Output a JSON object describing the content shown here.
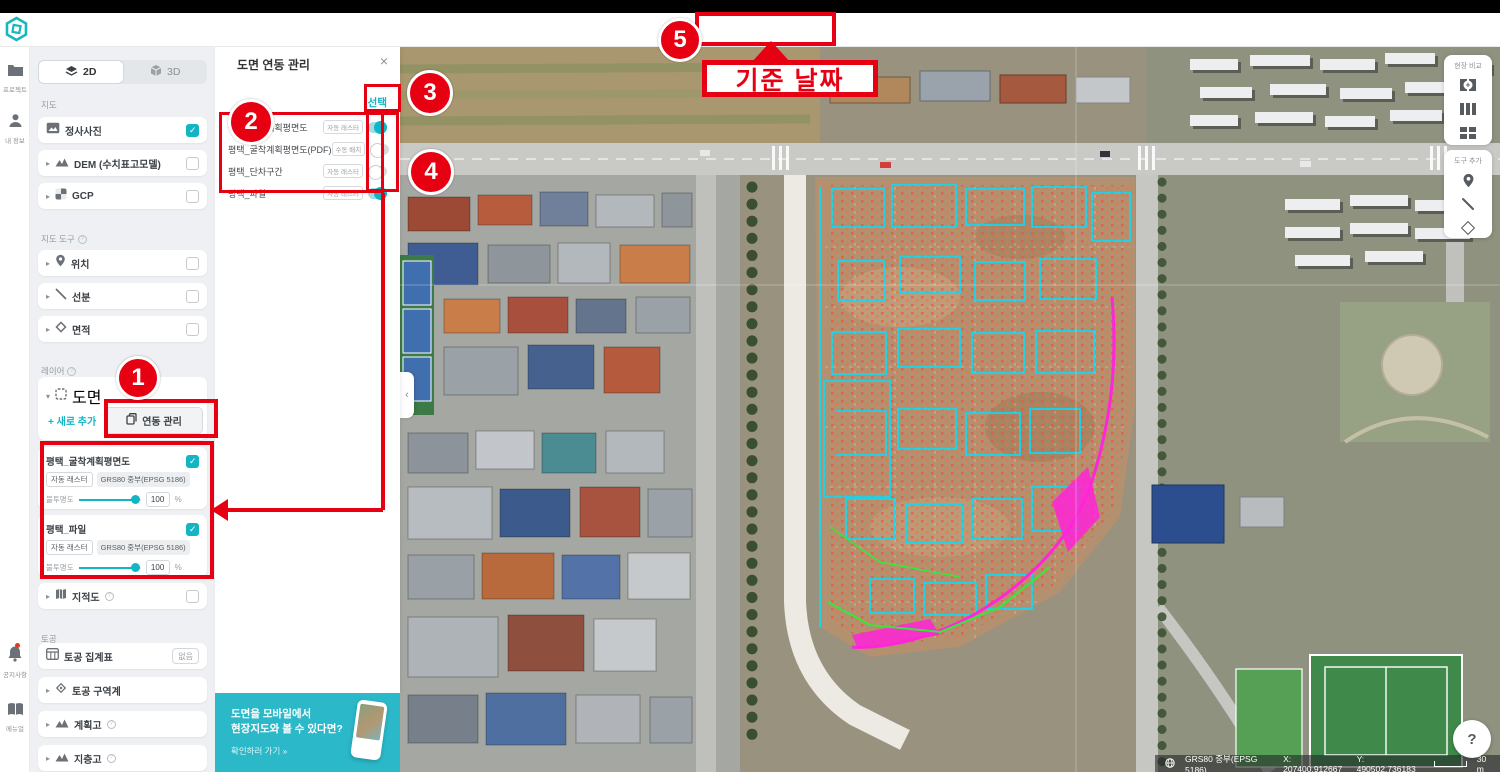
{
  "header": {
    "title": "[meissa] demo site",
    "date_label": "2020년 11월 24일 (화)",
    "admin_badge": "최고 관리자"
  },
  "icons": {
    "back": "←",
    "chevron_right": "›",
    "close": "×",
    "more": "⋯",
    "expand": "▸",
    "collapse": "▾",
    "panel_collapse": "‹",
    "check": "✓"
  },
  "rail": {
    "items": [
      {
        "label": "프로젝트"
      },
      {
        "label": "내 정보"
      },
      {
        "label": "공지사항"
      },
      {
        "label": "메뉴얼"
      }
    ]
  },
  "panel": {
    "tab_2d": "2D",
    "tab_3d": "3D",
    "map_section": "지도",
    "ortho_label": "정사사진",
    "ortho_checked": true,
    "dem_label": "DEM (수치표고모델)",
    "dem_checked": false,
    "gcp_label": "GCP",
    "gcp_checked": false,
    "tools_section": "지도 도구",
    "location_label": "위치",
    "location_checked": false,
    "segment_label": "선분",
    "segment_checked": false,
    "area_label": "면적",
    "area_checked": false,
    "layers_section": "레이어",
    "drawing_label": "도면",
    "add_new_label": "+ 새로 추가",
    "link_manage_label": "연동 관리",
    "layer_cards": [
      {
        "name": "평택_굴착계획평면도",
        "checked": true,
        "badge1": "자동 래스터",
        "badge2": "GRS80 중부(EPSG 5186)",
        "opacity_label": "불투명도",
        "opacity_value": "100",
        "opacity_unit": "%"
      },
      {
        "name": "평택_파일",
        "checked": true,
        "badge1": "자동 래스터",
        "badge2": "GRS80 중부(EPSG 5186)",
        "opacity_label": "불투명도",
        "opacity_value": "100",
        "opacity_unit": "%"
      }
    ],
    "cadastral_label": "지적도",
    "cadastral_checked": false,
    "earthwork_section": "토공",
    "earthwork_table_label": "토공 집계표",
    "earthwork_table_badge": "없음",
    "earthwork_zone_label": "토공 구역계",
    "plan_height_label": "계획고",
    "strata_height_label": "지층고"
  },
  "popup": {
    "title": "도면 연동 관리",
    "select_label": "선택",
    "rows": [
      {
        "name": "평택_굴착계획평면도",
        "badge": "자동 래스터",
        "on": true
      },
      {
        "name": "평택_굴착계획평면도(PDF)",
        "badge": "수동 배치",
        "on": false
      },
      {
        "name": "평택_단차구간",
        "badge": "자동 래스터",
        "on": false
      },
      {
        "name": "평택_파일",
        "badge": "자동 래스터",
        "on": true
      }
    ]
  },
  "banner": {
    "text": "도면을 모바일에서\n현장지도와 볼 수 있다면?",
    "link": "확인하러 가기 »"
  },
  "map_side": {
    "compare_label": "현장 비교",
    "tools_label": "도구 추가"
  },
  "statusbar": {
    "crs": "GRS80 중부(EPSG 5186)",
    "x": "X: 207400.912667",
    "y": "Y: 490502.736183",
    "scale": "30 m"
  },
  "help_label": "?",
  "annotations": {
    "n1": "1",
    "n2": "2",
    "n3": "3",
    "n4": "4",
    "n5": "5",
    "callout": "기준 날짜"
  },
  "colors": {
    "accent": "#12b5c4",
    "annotation_red": "#e60012",
    "banner_teal": "#2bb8c8"
  }
}
